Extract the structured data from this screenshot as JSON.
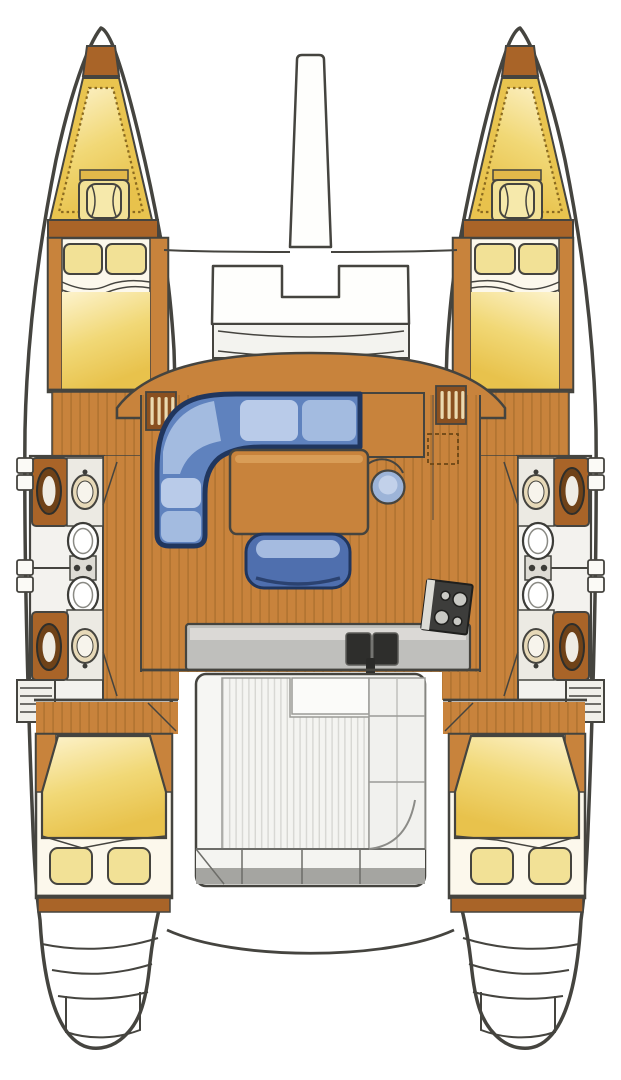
{
  "diagram": {
    "type": "yacht-interior-floor-plan",
    "subject": "sailing-catamaran-deck-layout",
    "canvas": {
      "width": 621,
      "height": 1080
    },
    "regions": [
      "bowsprit-beam",
      "forward-crossbeam",
      "anchor-locker",
      "foredeck-bench",
      "port-forepeak-berth",
      "starboard-forepeak-berth",
      "port-forward-cabin-bed",
      "starboard-forward-cabin-bed",
      "port-forward-head",
      "port-aft-head",
      "starboard-forward-head",
      "starboard-aft-head",
      "salon-floor",
      "salon-settee",
      "salon-table",
      "salon-ottoman",
      "salon-stool",
      "galley-counter",
      "galley-double-sink",
      "galley-stove",
      "cockpit-floor",
      "cockpit-bench",
      "port-aft-cabin-bed",
      "starboard-aft-cabin-bed",
      "port-transom-steps",
      "starboard-transom-steps",
      "aft-crossbeam"
    ]
  },
  "colors": {
    "outline": "#45443f",
    "hull_fill": "#ffffff",
    "wood": "#c8833c",
    "wood_dark": "#a96428",
    "plank_line": "#a2692a",
    "pillow": "#f2e196",
    "mattress_light": "#fdf3cd",
    "mattress_mid": "#f1d876",
    "mattress_deep": "#e8c24c",
    "sofa_dark": "#20365e",
    "sofa_mid": "#5f82be",
    "sofa_light": "#b9cbe9",
    "sofa_alt": "#a3bbe0",
    "counter": "#bfbfbc",
    "sink_dark": "#2e2e2c",
    "stove": "#3d3d3b",
    "cockpit_floor": "#f4f4f1",
    "slat_line": "#d7d7d3",
    "bench_front": "#a5a5a1"
  }
}
